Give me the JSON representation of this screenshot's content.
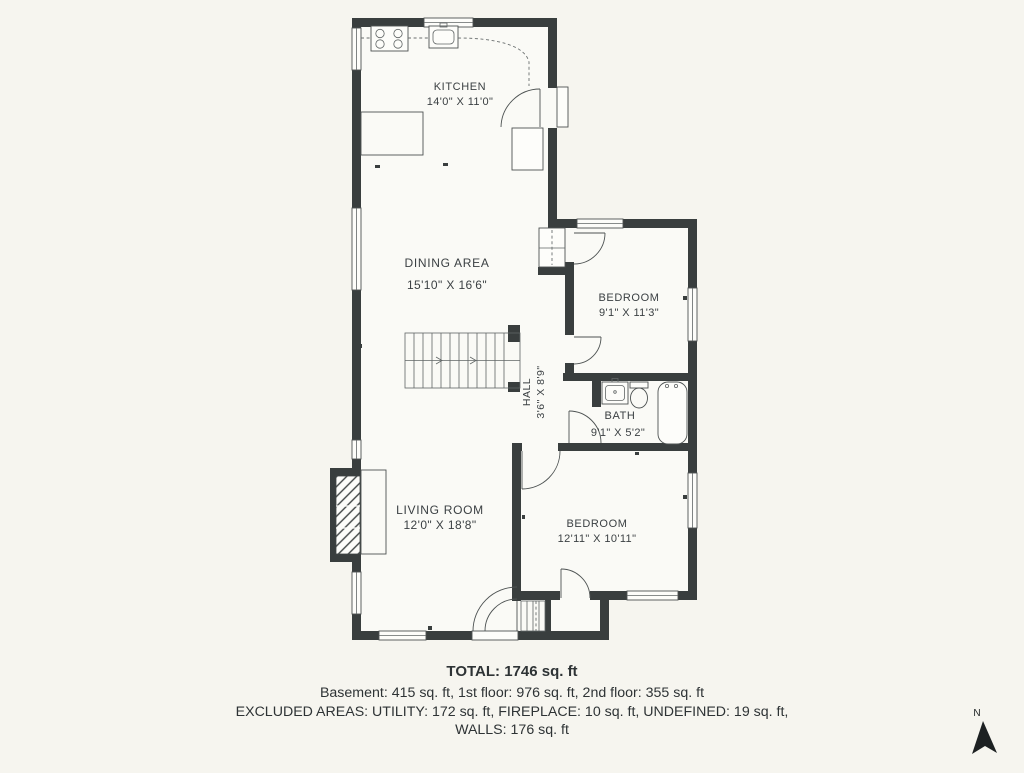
{
  "plan": {
    "rooms": {
      "kitchen": {
        "name": "KITCHEN",
        "dims": "14'0\" X 11'0\""
      },
      "dining": {
        "name": "DINING AREA",
        "dims": "15'10\" X 16'6\""
      },
      "bedroom1": {
        "name": "BEDROOM",
        "dims": "9'1\" X 11'3\""
      },
      "hall": {
        "name": "HALL",
        "dims": "3'6\" X 8'9\""
      },
      "bath": {
        "name": "BATH",
        "dims": "9'1\" X 5'2\""
      },
      "living": {
        "name": "LIVING ROOM",
        "dims": "12'0\" X 18'8\""
      },
      "bedroom2": {
        "name": "BEDROOM",
        "dims": "12'11\" X 10'11\""
      }
    }
  },
  "summary": {
    "total": "TOTAL: 1746 sq. ft",
    "floors": "Basement: 415 sq. ft, 1st floor: 976 sq. ft, 2nd floor: 355 sq. ft",
    "excluded": "EXCLUDED AREAS: UTILITY: 172 sq. ft, FIREPLACE: 10 sq. ft, UNDEFINED: 19 sq. ft,",
    "walls": "WALLS: 176 sq. ft"
  },
  "compass": {
    "north_label": "N"
  },
  "colors": {
    "wall": "#393e3e",
    "background": "#f6f5ef",
    "floor": "#fafaf6",
    "text": "#3b4043",
    "line": "#4d5252"
  }
}
